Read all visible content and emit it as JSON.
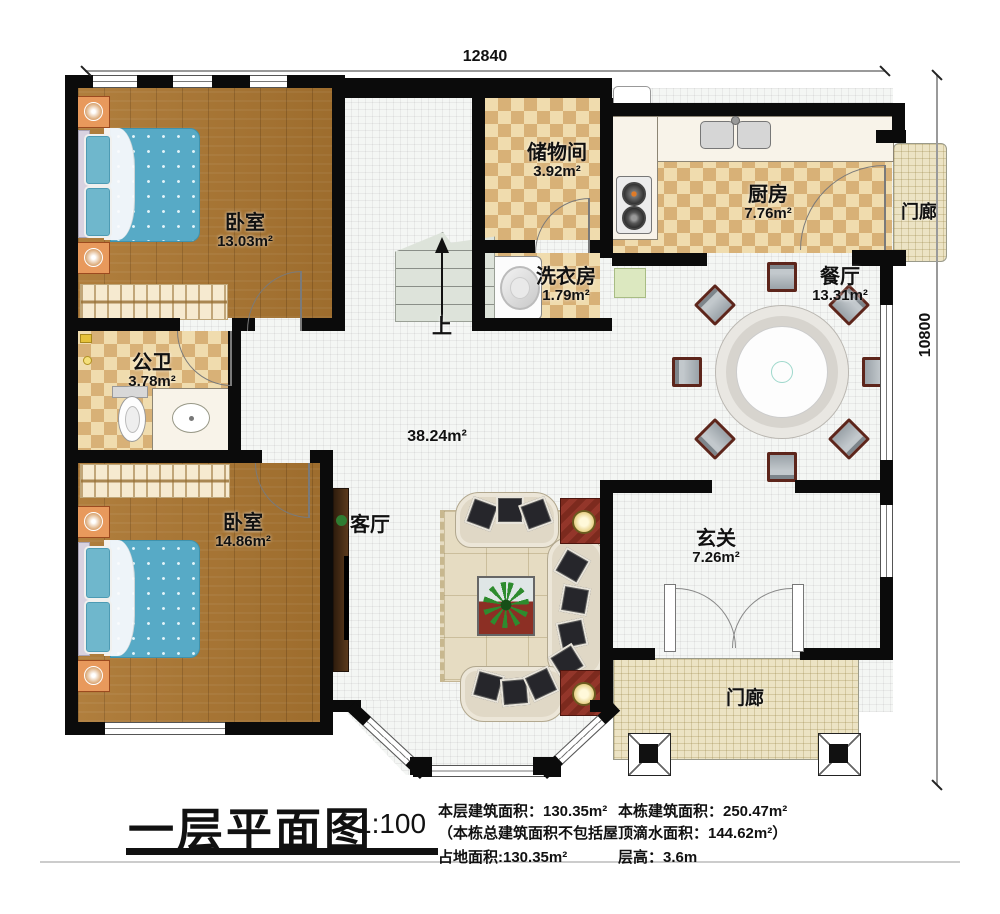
{
  "dimensions": {
    "width_label": "12840",
    "height_label": "10800"
  },
  "rooms": {
    "bedroom_top": {
      "name": "卧室",
      "area": "13.03m²"
    },
    "storage": {
      "name": "储物间",
      "area": "3.92m²"
    },
    "kitchen": {
      "name": "厨房",
      "area": "7.76m²"
    },
    "porch_right": {
      "name": "门廊"
    },
    "laundry": {
      "name": "洗衣房",
      "area": "1.79m²"
    },
    "dining": {
      "name": "餐厅",
      "area": "13.31m²"
    },
    "bathroom": {
      "name": "公卫",
      "area": "3.78m²"
    },
    "hall": {
      "area": "38.24m²"
    },
    "bedroom_bottom": {
      "name": "卧室",
      "area": "14.86m²"
    },
    "living": {
      "name": "客厅"
    },
    "foyer": {
      "name": "玄关",
      "area": "7.26m²"
    },
    "porch_bottom": {
      "name": "门廊"
    }
  },
  "stairs": {
    "up": "上"
  },
  "title": {
    "text": "一层平面图",
    "scale": "1:100",
    "stat1a": "本层建筑面积：130.35m²",
    "stat1b": "本栋建筑面积：250.47m²",
    "stat2": "（本栋总建筑面积不包括屋顶滴水面积：144.62m²）",
    "stat3a": "占地面积:130.35m²",
    "stat3b": "层高：3.6m"
  },
  "colors": {
    "wall": "#0b0b0b",
    "wood": "#ab7631",
    "tile_dark": "#d8b177",
    "tile_light": "#f0dcae",
    "floor": "#f4f6f4",
    "porch": "#ece3c4",
    "bed": "#57aac6",
    "accent_red": "#8c2f24"
  }
}
